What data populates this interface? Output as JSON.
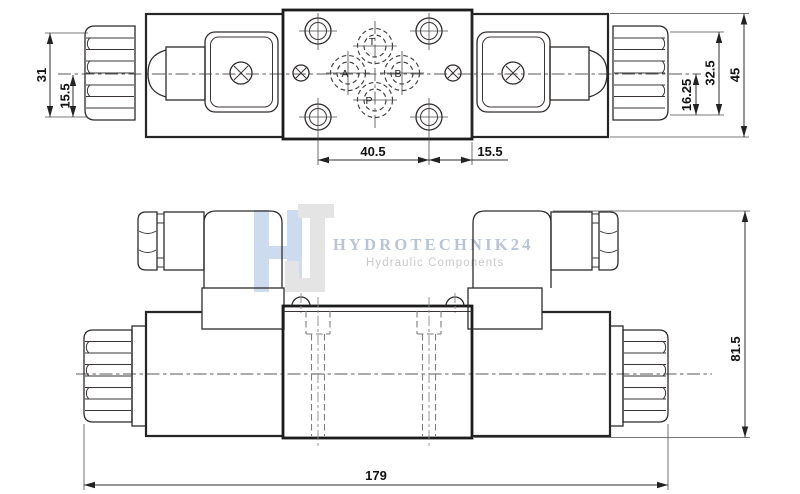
{
  "watermark": {
    "brand": "HYDROTECHNIK24",
    "tagline": "Hydraulic Components",
    "brand_color": "#b8c4d6",
    "tagline_color": "#c8c8c8",
    "logo_h_color": "#ccdbee",
    "logo_j_color": "#e4e4e4"
  },
  "top_view": {
    "ports": {
      "t": "T",
      "a": "A",
      "b": "B",
      "p": "P"
    },
    "dims": {
      "nut_height": "31",
      "nut_half_height": "15.5",
      "hole_spacing": "40.5",
      "hole_edge_offset": "15.5",
      "center_to_flat": "16.25",
      "flats_height": "32.5",
      "body_height": "45"
    }
  },
  "front_view": {
    "dims": {
      "overall_height": "81.5",
      "overall_length": "179"
    }
  },
  "drawing": {
    "line_color": "#262626",
    "hidden_line_color": "#7d7d7d"
  }
}
